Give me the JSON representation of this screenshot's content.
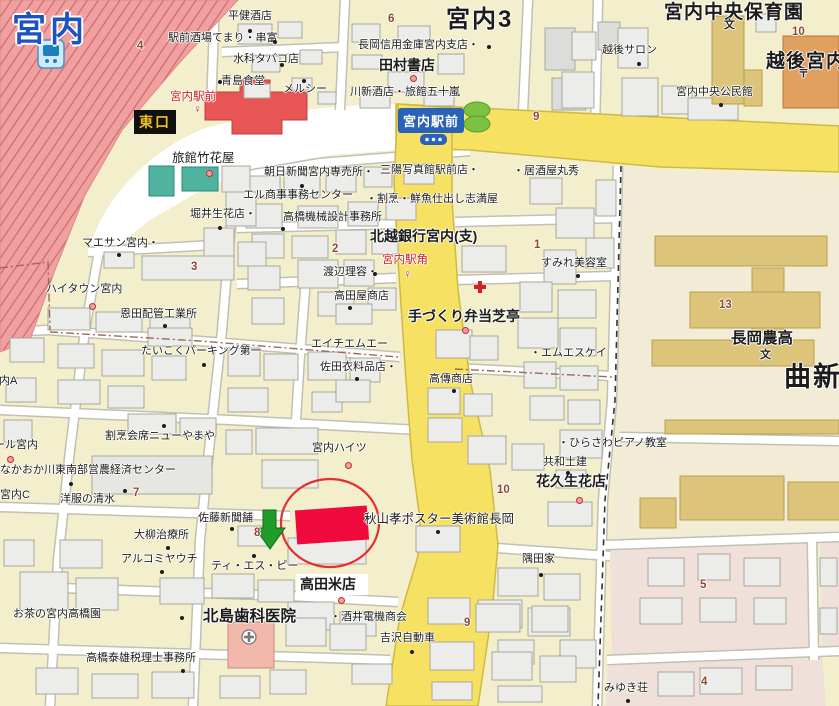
{
  "map": {
    "station_name": "宮内",
    "east_exit": "東口",
    "intersection": "宮内駅前",
    "district_labels": [
      "宮内3",
      "曲新",
      "宮内A",
      "宮内C"
    ],
    "colors": {
      "base": "#f3eecb",
      "road_yellow": "#f7e163",
      "railway_pink": "#f0a0a0",
      "station_red": "#e85555",
      "highlight_red": "#ee0a3c",
      "ellipse_red": "#e62e2e",
      "arrow_green": "#1f9c2a",
      "teal_building": "#4fb3a0",
      "school_tan": "#dcc47a",
      "post_office_orange": "#e0a060",
      "pink_block": "#f0e0da",
      "label_blue_box": "#2a62b8"
    },
    "labels": [
      {
        "t": "平健酒店",
        "x": 228,
        "y": 11,
        "c": "ls"
      },
      {
        "t": "駅前酒場てまり・串富",
        "x": 168,
        "y": 33,
        "c": "ls"
      },
      {
        "t": "水科タバコ店",
        "x": 233,
        "y": 54,
        "c": "ls"
      },
      {
        "t": "青島食堂",
        "x": 221,
        "y": 76,
        "c": "ls"
      },
      {
        "t": "メルシー",
        "x": 283,
        "y": 84,
        "c": "ls"
      },
      {
        "t": "長岡信用金庫宮内支店・",
        "x": 358,
        "y": 40,
        "c": "ls"
      },
      {
        "t": "田村書店",
        "x": 379,
        "y": 58,
        "c": "lb"
      },
      {
        "t": "川新酒店・旅館五十嵐",
        "x": 350,
        "y": 87,
        "c": "ls"
      },
      {
        "t": "宮内3",
        "x": 446,
        "y": 8,
        "c": "lX"
      },
      {
        "t": "越後サロン",
        "x": 602,
        "y": 45,
        "c": "ls"
      },
      {
        "t": "宮内中央保育園",
        "x": 664,
        "y": 3,
        "c": "lB"
      },
      {
        "t": "越後宮内局",
        "x": 766,
        "y": 52,
        "c": "lB"
      },
      {
        "t": "宮内中央公民館",
        "x": 676,
        "y": 87,
        "c": "ls"
      },
      {
        "t": "旅館竹花屋",
        "x": 172,
        "y": 152,
        "c": "lm"
      },
      {
        "t": "朝日新聞宮内専売所・",
        "x": 264,
        "y": 167,
        "c": "ls"
      },
      {
        "t": "三陽写真館駅前店・",
        "x": 380,
        "y": 165,
        "c": "ls"
      },
      {
        "t": "・居酒屋丸秀",
        "x": 513,
        "y": 166,
        "c": "ls"
      },
      {
        "t": "エル商事事務センター",
        "x": 243,
        "y": 190,
        "c": "ls"
      },
      {
        "t": "・割烹・鮮魚仕出し志満屋",
        "x": 366,
        "y": 194,
        "c": "ls"
      },
      {
        "t": "高橋機械設計事務所",
        "x": 283,
        "y": 212,
        "c": "ls"
      },
      {
        "t": "堀井生花店・",
        "x": 190,
        "y": 209,
        "c": "ls"
      },
      {
        "t": "北越銀行宮内(支)",
        "x": 370,
        "y": 229,
        "c": "lb"
      },
      {
        "t": "渡辺理容・",
        "x": 323,
        "y": 267,
        "c": "ls"
      },
      {
        "t": "すみれ美容室",
        "x": 541,
        "y": 258,
        "c": "ls"
      },
      {
        "t": "マエサン宮内・",
        "x": 82,
        "y": 238,
        "c": "ls"
      },
      {
        "t": "ハイタウン宮内",
        "x": 46,
        "y": 284,
        "c": "ls"
      },
      {
        "t": "恩田配管工業所",
        "x": 120,
        "y": 309,
        "c": "ls"
      },
      {
        "t": "高田屋商店",
        "x": 334,
        "y": 291,
        "c": "ls"
      },
      {
        "t": "手づくり弁当芝亭",
        "x": 408,
        "y": 309,
        "c": "lb"
      },
      {
        "t": "エイチエムエー",
        "x": 311,
        "y": 339,
        "c": "ls"
      },
      {
        "t": "佐田衣料品店・",
        "x": 320,
        "y": 362,
        "c": "ls"
      },
      {
        "t": "たいこくパーキング第一",
        "x": 141,
        "y": 346,
        "c": "ls"
      },
      {
        "t": "高傳商店",
        "x": 429,
        "y": 374,
        "c": "ls"
      },
      {
        "t": "・エムエスケイ",
        "x": 530,
        "y": 348,
        "c": "ls"
      },
      {
        "t": "長岡農高",
        "x": 731,
        "y": 331,
        "c": "lb16"
      },
      {
        "t": "曲新",
        "x": 784,
        "y": 364,
        "c": "lH"
      },
      {
        "t": "宮内A",
        "x": -12,
        "y": 376,
        "c": "ls"
      },
      {
        "t": "ール宮内",
        "x": -6,
        "y": 440,
        "c": "ls"
      },
      {
        "t": "割烹会席ニューやまや",
        "x": 105,
        "y": 431,
        "c": "ls"
      },
      {
        "t": "宮内ハイツ",
        "x": 312,
        "y": 443,
        "c": "ls"
      },
      {
        "t": "・ひらさわピアノ教室",
        "x": 558,
        "y": 438,
        "c": "ls"
      },
      {
        "t": "共和土建",
        "x": 543,
        "y": 457,
        "c": "ls"
      },
      {
        "t": "なかおか川東南部営農経済センター",
        "x": 0,
        "y": 465,
        "c": "ls"
      },
      {
        "t": "宮内C",
        "x": 0,
        "y": 490,
        "c": "ls"
      },
      {
        "t": "洋服の清水",
        "x": 60,
        "y": 494,
        "c": "ls"
      },
      {
        "t": "花久生花店",
        "x": 536,
        "y": 474,
        "c": "lb"
      },
      {
        "t": "佐藤新聞舗",
        "x": 198,
        "y": 513,
        "c": "ls"
      },
      {
        "t": "秋山孝ポスター美術館長岡",
        "x": 364,
        "y": 513,
        "c": "lm"
      },
      {
        "t": "大柳治療所",
        "x": 134,
        "y": 530,
        "c": "ls"
      },
      {
        "t": "アルコミヤウチ",
        "x": 121,
        "y": 554,
        "c": "ls"
      },
      {
        "t": "ティ・エス・ピー",
        "x": 211,
        "y": 561,
        "c": "ls"
      },
      {
        "t": "隅田家",
        "x": 522,
        "y": 554,
        "c": "ls"
      },
      {
        "t": "高田米店",
        "x": 300,
        "y": 577,
        "c": "lb"
      },
      {
        "t": "お茶の宮内高橋園",
        "x": 13,
        "y": 609,
        "c": "ls"
      },
      {
        "t": "北島歯科医院",
        "x": 203,
        "y": 609,
        "c": "lb16"
      },
      {
        "t": "・酒井電機商会",
        "x": 330,
        "y": 612,
        "c": "ls"
      },
      {
        "t": "吉沢自動車",
        "x": 380,
        "y": 633,
        "c": "ls"
      },
      {
        "t": "高橋泰雄税理士事務所",
        "x": 86,
        "y": 653,
        "c": "ls"
      },
      {
        "t": "みゆき荘",
        "x": 604,
        "y": 683,
        "c": "ls"
      }
    ],
    "road_numbers": [
      {
        "t": "4",
        "x": 137,
        "y": 41
      },
      {
        "t": "6",
        "x": 388,
        "y": 14
      },
      {
        "t": "9",
        "x": 533,
        "y": 112
      },
      {
        "t": "10",
        "x": 792,
        "y": 27
      },
      {
        "t": "1",
        "x": 534,
        "y": 240
      },
      {
        "t": "2",
        "x": 332,
        "y": 244
      },
      {
        "t": "3",
        "x": 191,
        "y": 262
      },
      {
        "t": "13",
        "x": 719,
        "y": 300
      },
      {
        "t": "7",
        "x": 133,
        "y": 488
      },
      {
        "t": "10",
        "x": 497,
        "y": 485
      },
      {
        "t": "8",
        "x": 254,
        "y": 528
      },
      {
        "t": "9",
        "x": 464,
        "y": 618
      },
      {
        "t": "5",
        "x": 700,
        "y": 580
      },
      {
        "t": "4",
        "x": 701,
        "y": 677
      }
    ],
    "bus_stops": [
      {
        "t": "宮内駅前",
        "x": 170,
        "y": 92,
        "gx": 193,
        "gy": 103
      },
      {
        "t": "宮内駅角",
        "x": 382,
        "y": 255,
        "gx": 403,
        "gy": 268
      }
    ],
    "symbol_glyphs": [
      {
        "g": "文",
        "x": 724,
        "y": 20
      },
      {
        "g": "文",
        "x": 760,
        "y": 350
      },
      {
        "g": "〒",
        "x": 798,
        "y": 69
      }
    ],
    "poi_black_dots": [
      [
        248,
        29
      ],
      [
        273,
        40
      ],
      [
        280,
        63
      ],
      [
        218,
        80
      ],
      [
        302,
        79
      ],
      [
        487,
        45
      ],
      [
        637,
        62
      ],
      [
        719,
        103
      ],
      [
        300,
        184
      ],
      [
        281,
        227
      ],
      [
        218,
        226
      ],
      [
        373,
        272
      ],
      [
        576,
        274
      ],
      [
        117,
        253
      ],
      [
        163,
        324
      ],
      [
        348,
        306
      ],
      [
        202,
        363
      ],
      [
        355,
        377
      ],
      [
        452,
        389
      ],
      [
        162,
        424
      ],
      [
        566,
        471
      ],
      [
        69,
        482
      ],
      [
        123,
        489
      ],
      [
        230,
        527
      ],
      [
        436,
        530
      ],
      [
        166,
        546
      ],
      [
        160,
        570
      ],
      [
        252,
        554
      ],
      [
        539,
        573
      ],
      [
        180,
        616
      ],
      [
        410,
        650
      ],
      [
        181,
        669
      ],
      [
        626,
        699
      ]
    ],
    "poi_red_markers": [
      [
        410,
        75
      ],
      [
        206,
        170
      ],
      [
        89,
        303
      ],
      [
        462,
        327
      ],
      [
        345,
        462
      ],
      [
        576,
        497
      ],
      [
        338,
        597
      ],
      [
        7,
        456
      ]
    ]
  }
}
